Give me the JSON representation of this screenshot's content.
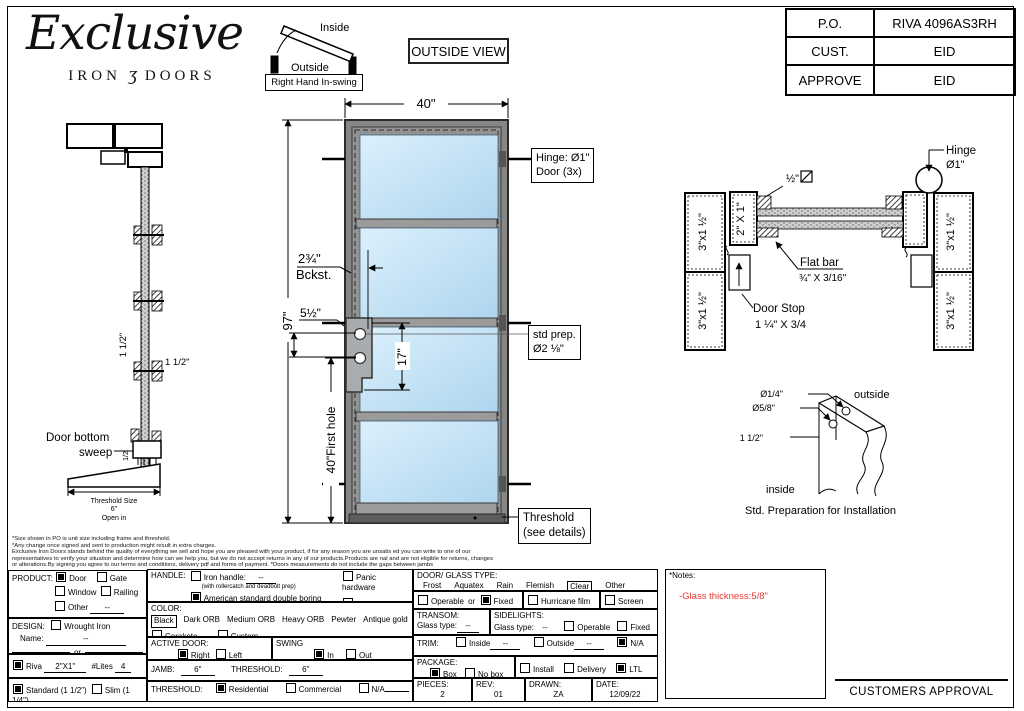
{
  "page": {
    "accent_red": "#e8392e",
    "glass_blue": "#bfe0f4",
    "frame_gray": "#8a8a8a"
  },
  "logo": {
    "script": "Exclusive",
    "iron": "IRON",
    "amp": "ʒ",
    "doors": "DOORS"
  },
  "swing": {
    "inside": "Inside",
    "outside": "Outside",
    "caption": "Right Hand In-swing"
  },
  "view_label": "OUTSIDE VIEW",
  "po_table": [
    {
      "label": "P.O.",
      "value": "RIVA 4096AS3RH"
    },
    {
      "label": "CUST.",
      "value": "EID"
    },
    {
      "label": "APPROVE",
      "value": "EID"
    }
  ],
  "elevation": {
    "width_dim": "40\"",
    "height_dim": "97\"",
    "first_hole_dim": "40\"First hole",
    "backset_1": "2¾\"",
    "backset_2": "Bckst.",
    "hole_gap_dim": "5½\"",
    "lock_span_dim": "17\"",
    "hinge_note_1": "Hinge: Ø1\"",
    "hinge_note_2": "Door (3x)",
    "prep_note_1": "std prep.",
    "prep_note_2": "Ø2 ⅛\"",
    "threshold_note_1": "Threshold",
    "threshold_note_2": "(see details)"
  },
  "jamb_section": {
    "dim_v": "1 1/2\"",
    "dim_h": "1 1/2\"",
    "sweep_dim": "1/2",
    "sweep_1": "Door bottom",
    "sweep_2": "sweep",
    "th_size_1": "Threshold Size",
    "th_size_2": "6\"",
    "th_size_3": "Open in"
  },
  "profile_section": {
    "glass_thk": "½\"",
    "p3": "3\"x1 ½\"",
    "p21": "2\" X 1\"",
    "flat_bar_1": "Flat bar",
    "flat_bar_2": "¾\" X 3/16\"",
    "door_stop_1": "Door Stop",
    "door_stop_2": "1 ¼\" X 3/4",
    "hinge_1": "Hinge",
    "hinge_2": "Ø1\""
  },
  "install_prep": {
    "dia_small": "Ø1/4\"",
    "dia_big": "Ø5/8\"",
    "offset": "1 1/2\"",
    "outside": "outside",
    "inside": "inside",
    "caption": "Std. Preparation for Installation"
  },
  "disclaimer": [
    "*Size shown in PO is unit size including frame and threshold.",
    "*Any change once signed and sent to production might result in extra charges.",
    "Exclusive Iron Doors stands behind the quality of everything we sell and hope you are pleased with your product, if for any reason you are unsatis ed you can write to one of our",
    "representatives to verify your situation and determine how can we help you, but we do not accept returns in any of our products.Products are  nal and are not eligible for returns, changes",
    "or alterations.By signing you agree to our terms and conditions, delivery pdf and forms of payment. *Doors measurements do not include the gaps between jambs"
  ],
  "form": {
    "product": {
      "label": "PRODUCT:",
      "door": "Door",
      "gate": "Gate",
      "window": "Window",
      "railing": "Railing",
      "other": "Other",
      "other_val": "--"
    },
    "design": {
      "label": "DESIGN:",
      "wrought": "Wrought Iron",
      "name": "Name:",
      "name_val": "--",
      "or": "or"
    },
    "riva": {
      "riva": "Riva",
      "riva_val": "2\"X1\"",
      "lites": "#Lites",
      "lites_val": "4"
    },
    "frame_type": {
      "standard": "Standard (1 1/2\")",
      "slim": "Slim (1 1/4\")"
    },
    "handle": {
      "label": "HANDLE:",
      "iron": "Iron handle:",
      "iron_val": "--",
      "iron_sub": "(with rollercatch and deadbolt prep)",
      "american": "American standard double boring",
      "panic": "Panic hardware",
      "other": "Other"
    },
    "color": {
      "label": "COLOR:",
      "options": [
        "Black",
        "Dark ORB",
        "Medium ORB",
        "Heavy ORB",
        "Pewter",
        "Antique gold"
      ],
      "selected": "Black",
      "cerakote": "Cerakote",
      "custom": "Custom"
    },
    "active_door": {
      "label": "ACTIVE DOOR:",
      "right": "Right",
      "left": "Left"
    },
    "swing": {
      "label": "SWING",
      "in": "In",
      "out": "Out"
    },
    "jamb": {
      "label": "JAMB:",
      "value": "6\"",
      "th_label": "THRESHOLD:",
      "th_value": "6\""
    },
    "threshold": {
      "label": "THRESHOLD:",
      "residential": "Residential",
      "commercial": "Commercial",
      "na": "N/A"
    },
    "glass": {
      "label": "DOOR/ GLASS TYPE:",
      "options": [
        "Frost",
        "Aquatex",
        "Rain",
        "Flemish",
        "Clear",
        "Other"
      ],
      "selected": "Clear",
      "operable": "Operable",
      "or": "or",
      "fixed": "Fixed",
      "hurricane": "Hurricane film",
      "screen": "Screen"
    },
    "transom": {
      "label": "TRANSOM:",
      "glass_type": "Glass type:",
      "value": "--"
    },
    "sidelights": {
      "label": "SIDELIGHTS:",
      "glass_type": "Glass type:",
      "value": "--",
      "operable": "Operable",
      "fixed": "Fixed"
    },
    "trim": {
      "label": "TRIM:",
      "inside": "Inside",
      "inside_val": "--",
      "outside": "Outside",
      "outside_val": "--",
      "na": "N/A"
    },
    "package": {
      "label": "PACKAGE:",
      "box": "Box",
      "no_box": "No box",
      "install": "Install",
      "delivery": "Delivery",
      "ltl": "LTL"
    },
    "meta": {
      "pieces_label": "PIECES:",
      "pieces": "2",
      "rev_label": "REV:",
      "rev": "01",
      "drawn_label": "DRAWN:",
      "drawn": "ZA",
      "date_label": "DATE:",
      "date": "12/09/22"
    },
    "notes": {
      "title": "*Notes:",
      "body": "-Glass thickness:5/8\""
    },
    "approval": "CUSTOMERS APPROVAL"
  },
  "checks": {
    "door": true,
    "gate": false,
    "window": false,
    "railing": false,
    "other": false,
    "wrought": false,
    "riva": true,
    "standard": true,
    "slim": false,
    "iron_handle": false,
    "american": true,
    "panic": false,
    "handle_other": false,
    "cerakote": false,
    "custom": false,
    "active_right": true,
    "active_left": false,
    "swing_in": true,
    "swing_out": false,
    "th_residential": true,
    "th_commercial": false,
    "th_na": false,
    "operable": false,
    "fixed": true,
    "hurricane": false,
    "screen": false,
    "sl_operable": false,
    "sl_fixed": false,
    "trim_inside": false,
    "trim_outside": false,
    "trim_na": true,
    "box": true,
    "no_box": false,
    "install": false,
    "delivery": false,
    "ltl": true
  }
}
